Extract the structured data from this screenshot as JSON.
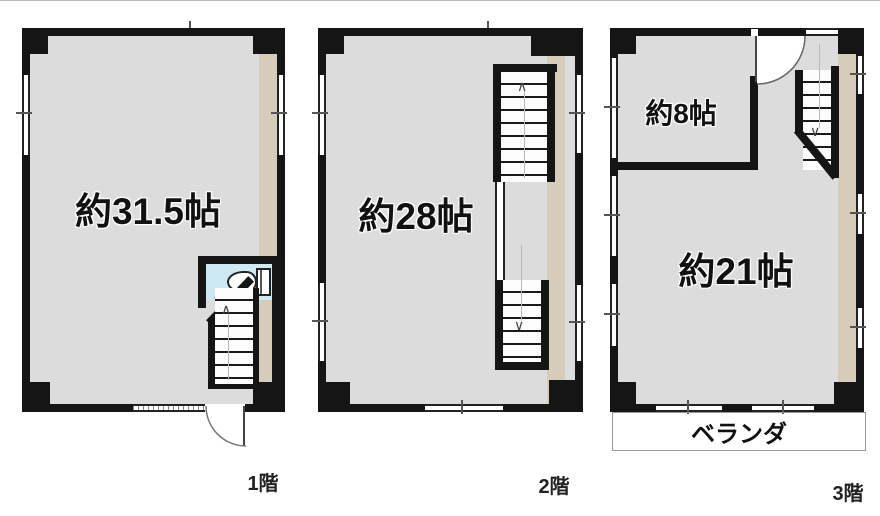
{
  "floors": [
    {
      "caption": "1階",
      "room_label": "約31.5帖"
    },
    {
      "caption": "2階",
      "room_label": "約28帖"
    },
    {
      "caption": "3階",
      "room_label": "約21帖",
      "room_small_label": "約8帖",
      "balcony_label": "ベランダ"
    }
  ],
  "symbols": {
    "stairs_up": "∧",
    "stairs_down": "∨"
  },
  "colors": {
    "wall": "#151515",
    "floor": "#dcdcdc",
    "accent_wall": "#d6ccba",
    "toilet_floor": "#cfe9f2"
  }
}
